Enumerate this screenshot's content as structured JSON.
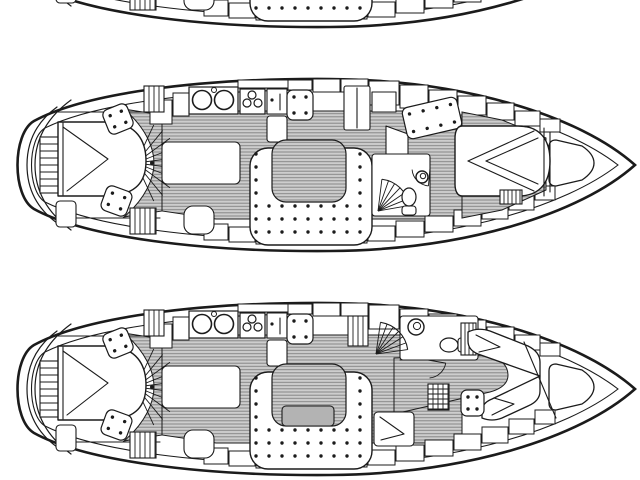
{
  "figure": {
    "kind": "sailing-yacht interior accommodation plans, black line drawing on white",
    "views": [
      {
        "id": "boat-plan-top",
        "label": "hull cropped at top edge",
        "plan": "A",
        "dy": -224
      },
      {
        "id": "boat-plan-middle",
        "label": "layout with island double berth forward",
        "plan": "A",
        "dy": 0
      },
      {
        "id": "boat-plan-bottom",
        "label": "layout with V-berths and forward head",
        "plan": "B",
        "dy": 224
      }
    ]
  },
  "colors": {
    "paper": "#ffffff",
    "ink": "#1b1b1b",
    "floor": "#cdcdcd",
    "floor_line": "#878787",
    "table": "#b3b3b3",
    "white": "#ffffff"
  },
  "diagram": {
    "canvas": {
      "w": 640,
      "h": 480
    },
    "shared": [
      {
        "t": "hull",
        "n": "hull-outline",
        "outer": "M 635,165 C 580,116 465,80 330,79 C 200,78 85,93 34,121 C 12,134 12,196 34,209 C 85,237 200,252 330,251 C 465,250 580,214 635,165 Z",
        "inner": "M 618,165 C 565,124 458,91 330,90 C 205,89 95,103 45,128 C 27,139 27,191 45,202 C 95,227 205,241 330,240 C 458,239 565,206 618,165 Z"
      },
      {
        "t": "path",
        "n": "transom-arc-outer",
        "d": "M 57,107 C 35,123 27,143 27,165 C 27,187 35,207 57,223",
        "sw": 1.2
      },
      {
        "t": "path",
        "n": "transom-arc-inner",
        "d": "M 71,100 C 45,119 35,142 35,165 C 35,188 45,211 71,230",
        "sw": 1.2
      },
      {
        "t": "hatch",
        "n": "stern-swim-ladder",
        "x": 40,
        "y": 137,
        "w": 21,
        "h": 56,
        "dir": "h",
        "step": 7
      },
      {
        "t": "floor",
        "n": "companionway-crescent-floor",
        "d": "M 124,109 L 162,115 L 162,211 L 124,217 C 146,198 154,178 154,163 C 154,148 146,128 124,109 Z"
      },
      {
        "t": "floor",
        "n": "saloon-floor",
        "d": "M 162,115 L 216,111 L 462,111 L 462,219 L 216,219 L 162,211 Z"
      },
      {
        "t": "fan",
        "n": "aft-cabin-steps-rays",
        "cx": 136,
        "cy": 163,
        "r": 42,
        "a0": -65,
        "a1": 65,
        "nl": 9,
        "noarc": true
      },
      {
        "t": "cabinets",
        "n": "hull-side-lockers-top",
        "items": [
          [
            150,
            100,
            22,
            24
          ],
          [
            173,
            93,
            16,
            23
          ],
          [
            238,
            80,
            50,
            8
          ],
          [
            288,
            80,
            24,
            10
          ],
          [
            313,
            79,
            27,
            13
          ],
          [
            341,
            79,
            27,
            13
          ],
          [
            369,
            81,
            30,
            24
          ],
          [
            400,
            85,
            28,
            23
          ],
          [
            429,
            90,
            28,
            21
          ],
          [
            458,
            96,
            28,
            19
          ],
          [
            487,
            103,
            27,
            17
          ],
          [
            515,
            111,
            25,
            15
          ],
          [
            540,
            119,
            20,
            13
          ]
        ]
      },
      {
        "t": "cabinets",
        "n": "hull-side-lockers-bottom",
        "items": [
          [
            204,
            224,
            24,
            16
          ],
          [
            229,
            227,
            26,
            15
          ],
          [
            256,
            230,
            26,
            14
          ],
          [
            283,
            231,
            28,
            13
          ],
          [
            312,
            231,
            28,
            13
          ],
          [
            341,
            229,
            26,
            14
          ],
          [
            368,
            226,
            27,
            15
          ],
          [
            396,
            221,
            28,
            16
          ],
          [
            425,
            216,
            28,
            16
          ],
          [
            454,
            210,
            27,
            16
          ],
          [
            482,
            203,
            26,
            16
          ],
          [
            509,
            195,
            25,
            15
          ],
          [
            535,
            186,
            20,
            14
          ]
        ]
      },
      {
        "t": "line",
        "n": "aft-cabin-wall-top",
        "x1": 58,
        "y1": 112,
        "x2": 160,
        "y2": 112
      },
      {
        "t": "line",
        "n": "aft-cabin-wall-bottom",
        "x1": 58,
        "y1": 218,
        "x2": 160,
        "y2": 218
      },
      {
        "t": "path",
        "n": "aft-double-berth",
        "d": "M 58,122 L 110,122 C 136,124 146,140 146,161 C 146,182 136,194 110,196 L 58,196 Z",
        "f": "w",
        "sw": 1.4
      },
      {
        "t": "pl",
        "n": "aft-berth-blanket-fold",
        "pts": [
          [
            63,
            127
          ],
          [
            108,
            159
          ],
          [
            67,
            191
          ]
        ]
      },
      {
        "t": "line",
        "n": "aft-berth-headboard",
        "x1": 63,
        "y1": 123,
        "x2": 63,
        "y2": 195
      },
      {
        "t": "rect",
        "n": "aft-cabin-nightstand",
        "x": 56,
        "y": 201,
        "w": 20,
        "h": 26,
        "r": 4
      },
      {
        "t": "hatch",
        "n": "aft-hanging-locker-top",
        "x": 144,
        "y": 86,
        "w": 20,
        "h": 26,
        "dir": "v",
        "step": 5
      },
      {
        "t": "hatch",
        "n": "aft-hanging-locker-bottom",
        "x": 130,
        "y": 208,
        "w": 26,
        "h": 26,
        "dir": "v",
        "step": 5
      },
      {
        "t": "dotseat",
        "n": "aft-cabin-seat-port",
        "x": 105,
        "y": 106,
        "w": 26,
        "h": 26,
        "rot": -22
      },
      {
        "t": "dotseat",
        "n": "aft-cabin-seat-starboard",
        "x": 103,
        "y": 188,
        "w": 27,
        "h": 26,
        "rot": 20
      },
      {
        "t": "rect",
        "n": "galley-island-counter",
        "x": 162,
        "y": 142,
        "w": 78,
        "h": 42,
        "r": 5
      },
      {
        "t": "sinks",
        "n": "galley-twin-sinks",
        "x": 189,
        "y": 87,
        "w": 49,
        "h": 27
      },
      {
        "t": "stove",
        "n": "galley-stove-burners",
        "x": 240,
        "y": 89,
        "w": 25,
        "h": 25
      },
      {
        "t": "rect",
        "n": "galley-worktop",
        "x": 267,
        "y": 89,
        "w": 20,
        "h": 25
      },
      {
        "t": "dot",
        "n": "worktop-knob",
        "x": 272,
        "y": 100,
        "r": 1.6
      },
      {
        "t": "line",
        "n": "worktop-divider",
        "x1": 280,
        "y1": 94,
        "x2": 280,
        "y2": 110
      },
      {
        "t": "rect",
        "n": "galley-fridge",
        "x": 267,
        "y": 116,
        "w": 20,
        "h": 26,
        "r": 3
      },
      {
        "t": "dotseat",
        "n": "saloon-seat-port",
        "x": 287,
        "y": 90,
        "w": 26,
        "h": 30,
        "rot": 0
      },
      {
        "t": "dotseat",
        "n": "saloon-seat-starboard",
        "x": 286,
        "y": 188,
        "w": 28,
        "h": 26,
        "rot": 10
      },
      {
        "t": "fan",
        "n": "starboard-seat-rays",
        "cx": 312,
        "cy": 214,
        "r": 26,
        "a0": 195,
        "a1": 265,
        "nl": 5,
        "noarc": true
      },
      {
        "t": "rect",
        "n": "aft-starboard-chair",
        "x": 184,
        "y": 206,
        "w": 30,
        "h": 28,
        "r": 9
      },
      {
        "t": "rect",
        "n": "aft-starboard-chair-2",
        "x": 262,
        "y": 204,
        "w": 24,
        "h": 28,
        "r": 8
      },
      {
        "t": "settee",
        "n": "u-shaped-settee",
        "outer": [
          250,
          148,
          122,
          97,
          18
        ],
        "notch": [
          272,
          140,
          74,
          62,
          14
        ]
      },
      {
        "t": "dot",
        "n": "mast-step",
        "x": 152,
        "y": 163,
        "r": 2
      },
      {
        "t": "path",
        "n": "bow-sail-locker",
        "d": "M 556,140 L 582,146 Q 594,154 594,163 Q 594,172 582,180 L 556,186 Q 549,186 549,179 L 549,147 Q 549,140 556,140 Z",
        "f": "w",
        "sw": 1.3
      }
    ],
    "plans": {
      "A": [
        {
          "t": "floor",
          "n": "forward-cabin-floor",
          "d": "M 462,112 L 502,120 L 546,138 L 546,190 L 502,210 L 462,218 Z"
        },
        {
          "t": "rect",
          "n": "wardrobe",
          "x": 344,
          "y": 86,
          "w": 26,
          "h": 44,
          "r": 2
        },
        {
          "t": "line",
          "n": "wardrobe-door-split",
          "x1": 357,
          "y1": 88,
          "x2": 357,
          "y2": 128
        },
        {
          "t": "rect",
          "n": "locker",
          "x": 372,
          "y": 92,
          "w": 24,
          "h": 20
        },
        {
          "t": "path",
          "n": "companionway-step",
          "d": "M 386,126 L 408,134 L 408,164 L 386,156 Z",
          "f": "w"
        },
        {
          "t": "rect",
          "n": "head-compartment",
          "x": 372,
          "y": 154,
          "w": 58,
          "h": 62,
          "r": 3
        },
        {
          "t": "fan",
          "n": "companionway-stairs",
          "cx": 378,
          "cy": 211,
          "r": 32,
          "a0": -83,
          "a1": -10,
          "nl": 6
        },
        {
          "t": "toilet",
          "n": "toilet",
          "cx": 409,
          "cy": 200,
          "rot": 180
        },
        {
          "t": "basin",
          "n": "washbasin",
          "cx": 422,
          "cy": 177,
          "r": 6
        },
        {
          "t": "arc",
          "n": "head-door-swing",
          "cx": 430,
          "cy": 168,
          "r": 18,
          "a0": 95,
          "a1": 175
        },
        {
          "t": "dotseat",
          "n": "forward-port-settee",
          "x": 404,
          "y": 102,
          "w": 56,
          "h": 32,
          "rot": -13
        },
        {
          "t": "path",
          "n": "island-double-berth",
          "d": "M 462,126 L 518,126 C 542,126 550,142 550,161 C 550,180 542,196 518,196 L 462,196 C 457,196 455,190 455,184 L 455,138 C 455,132 457,126 462,126 Z",
          "f": "w",
          "sw": 1.4
        },
        {
          "t": "pl",
          "n": "berth-fold-1",
          "pts": [
            [
              468,
              161
            ],
            [
              534,
              131
            ]
          ]
        },
        {
          "t": "pl",
          "n": "berth-fold-2",
          "pts": [
            [
              468,
              161
            ],
            [
              534,
              191
            ]
          ]
        },
        {
          "t": "pl",
          "n": "berth-fold-3",
          "pts": [
            [
              486,
              161
            ],
            [
              538,
              138
            ]
          ]
        },
        {
          "t": "pl",
          "n": "berth-fold-4",
          "pts": [
            [
              486,
              161
            ],
            [
              538,
              184
            ]
          ]
        },
        {
          "t": "line",
          "n": "forward-bulkhead-1",
          "x1": 550,
          "y1": 132,
          "x2": 550,
          "y2": 192
        },
        {
          "t": "line",
          "n": "forward-bulkhead-2",
          "x1": 544,
          "y1": 128,
          "x2": 544,
          "y2": 196
        },
        {
          "t": "hatch",
          "n": "forward-step-hatch",
          "x": 500,
          "y": 190,
          "w": 22,
          "h": 14,
          "dir": "v",
          "step": 4
        }
      ],
      "B": [
        {
          "t": "floor",
          "n": "forward-corridor-floor",
          "d": "M 394,134 L 490,131 Q 508,138 508,151 Q 508,163 490,168 L 394,190 Z"
        },
        {
          "t": "rect",
          "n": "forward-head-compartment",
          "x": 400,
          "y": 92,
          "w": 78,
          "h": 44,
          "r": 3
        },
        {
          "t": "basin",
          "n": "head-washbasin",
          "cx": 416,
          "cy": 103,
          "r": 8
        },
        {
          "t": "toilet",
          "n": "head-toilet",
          "cx": 452,
          "cy": 121,
          "rot": 90
        },
        {
          "t": "hatch",
          "n": "head-cistern-locker",
          "x": 461,
          "y": 99,
          "w": 15,
          "h": 32,
          "dir": "v",
          "step": 4
        },
        {
          "t": "arc",
          "n": "head-door-swing",
          "cx": 428,
          "cy": 136,
          "r": 18,
          "a0": 10,
          "a1": 85
        },
        {
          "t": "line",
          "n": "head-wall",
          "x1": 400,
          "y1": 136,
          "x2": 446,
          "y2": 136
        },
        {
          "t": "fan",
          "n": "companionway-stairs",
          "cx": 376,
          "cy": 130,
          "r": 32,
          "a0": -82,
          "a1": -8,
          "nl": 6
        },
        {
          "t": "hatch",
          "n": "companionway-ladder",
          "x": 348,
          "y": 92,
          "w": 20,
          "h": 30,
          "dir": "v",
          "step": 5
        },
        {
          "t": "path",
          "n": "v-berth-port",
          "d": "M 468,108 Q 478,103 490,107 L 528,122 Q 540,128 540,138 L 540,152 L 478,130 Q 468,126 468,117 Z",
          "f": "w",
          "sw": 1.3
        },
        {
          "t": "pl",
          "n": "v-berth-port-fold",
          "pts": [
            [
              476,
              111
            ],
            [
              500,
              123
            ],
            [
              479,
              128
            ]
          ]
        },
        {
          "t": "path",
          "n": "v-berth-starboard",
          "d": "M 482,194 Q 492,198 502,194 L 528,182 Q 540,177 540,167 L 540,152 L 492,175 Q 482,179 482,187 Z",
          "f": "w",
          "sw": 1.3
        },
        {
          "t": "pl",
          "n": "v-berth-starboard-fold",
          "pts": [
            [
              492,
              191
            ],
            [
              514,
              180
            ],
            [
              494,
              174
            ]
          ]
        },
        {
          "t": "line",
          "n": "bow-bulkhead-diagonal",
          "x1": 524,
          "y1": 118,
          "x2": 556,
          "y2": 194
        },
        {
          "t": "hatch",
          "n": "forward-ladder",
          "x": 428,
          "y": 160,
          "w": 21,
          "h": 26,
          "dir": "grid",
          "step": 5
        },
        {
          "t": "dotseat",
          "n": "forward-seat",
          "x": 461,
          "y": 166,
          "w": 23,
          "h": 26,
          "rot": 0
        },
        {
          "t": "rect",
          "n": "aft-quarter-locker",
          "x": 374,
          "y": 188,
          "w": 40,
          "h": 34,
          "r": 4
        },
        {
          "t": "pl",
          "n": "quarter-locker-fold",
          "pts": [
            [
              380,
              193
            ],
            [
              404,
              210
            ],
            [
              381,
              216
            ]
          ]
        },
        {
          "t": "table",
          "n": "saloon-table",
          "x": 282,
          "y": 182,
          "w": 52,
          "h": 20,
          "r": 4,
          "f": "g"
        }
      ]
    }
  }
}
